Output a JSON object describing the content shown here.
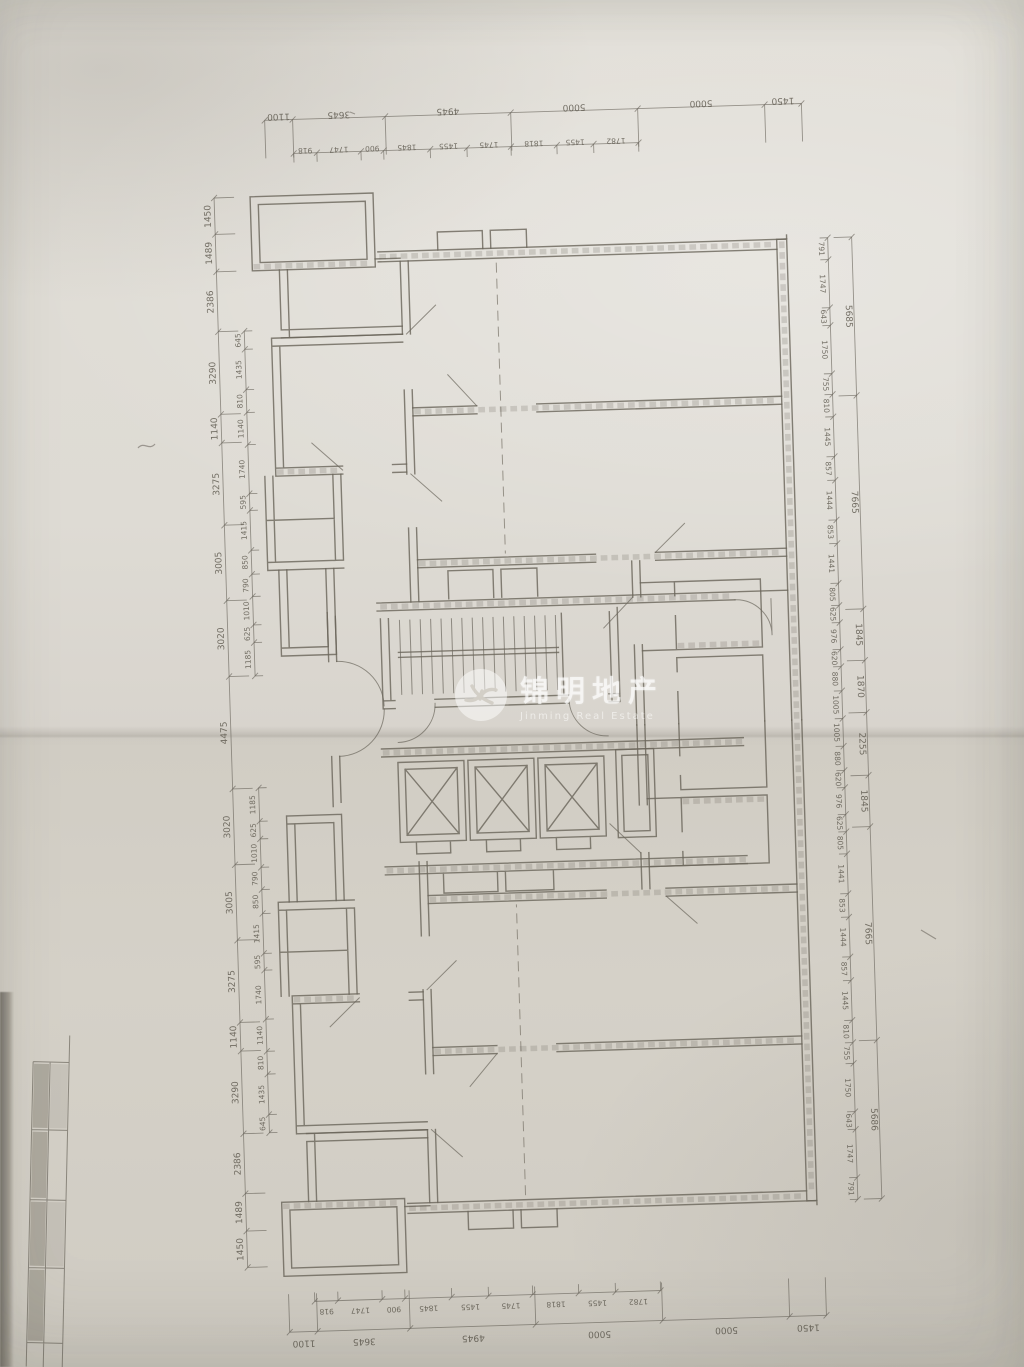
{
  "watermark": {
    "cn": "锦明地产",
    "en": "Jinming Real Estate",
    "logo": "swirl-circle-logo"
  },
  "colors": {
    "paper": "#dcd8d1",
    "ink": "#6b665c",
    "watermark": "#ffffff"
  },
  "dimensions": {
    "top": {
      "outer": [
        1100,
        3645,
        4945,
        5000,
        5000,
        1450
      ],
      "inner": [
        918,
        1747,
        900,
        1845,
        1455,
        1745,
        1818,
        1455,
        1782
      ]
    },
    "bottom": {
      "outer": [
        1100,
        3645,
        4945,
        5000,
        5000,
        1450
      ],
      "inner": [
        918,
        1747,
        900,
        1845,
        1455,
        1745,
        1818,
        1455,
        1782
      ]
    },
    "right": {
      "groups": [
        5685,
        7665,
        1845,
        1870,
        2255,
        1845,
        7665,
        5686
      ],
      "chain": [
        791,
        1747,
        643,
        1750,
        755,
        810,
        1445,
        857,
        1444,
        853,
        1441,
        805,
        625,
        976,
        620,
        880,
        1005,
        1005,
        880,
        620,
        976,
        625,
        805,
        1441,
        853,
        1444,
        857,
        1445,
        810,
        755,
        1750,
        643,
        1747,
        791
      ]
    },
    "left": {
      "groups": [
        1450,
        1489,
        2386,
        3290,
        1140,
        3275,
        3005,
        3020,
        4475,
        3020,
        3005,
        3275,
        1140,
        3290,
        2386,
        1489,
        1450
      ],
      "chain_upper": [
        645,
        1435,
        810,
        1140,
        1740,
        595,
        1415,
        850,
        790,
        1010,
        625,
        1185
      ],
      "chain_lower": [
        1185,
        625,
        1010,
        790,
        850,
        1415,
        595,
        1740,
        1140,
        810,
        1435,
        645
      ]
    }
  }
}
